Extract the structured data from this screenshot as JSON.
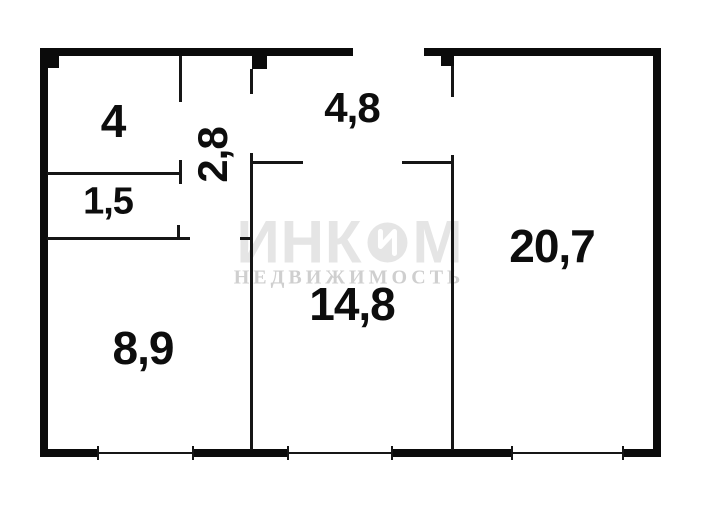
{
  "floorplan": {
    "rooms": [
      {
        "label": "4"
      },
      {
        "label": "1,5"
      },
      {
        "label": "2,8"
      },
      {
        "label": "4,8"
      },
      {
        "label": "8,9"
      },
      {
        "label": "14,8"
      },
      {
        "label": "20,7"
      }
    ],
    "watermark": {
      "brand": "ИНКОМ",
      "brand_left": "ИНК",
      "brand_right": "М",
      "subtitle": "НЕДВИЖИМОСТЬ"
    },
    "colors": {
      "wall": "#0b0b0b",
      "background": "#ffffff",
      "watermark_light": "#e5e5e5",
      "watermark_mid": "#cfcfcf"
    }
  }
}
